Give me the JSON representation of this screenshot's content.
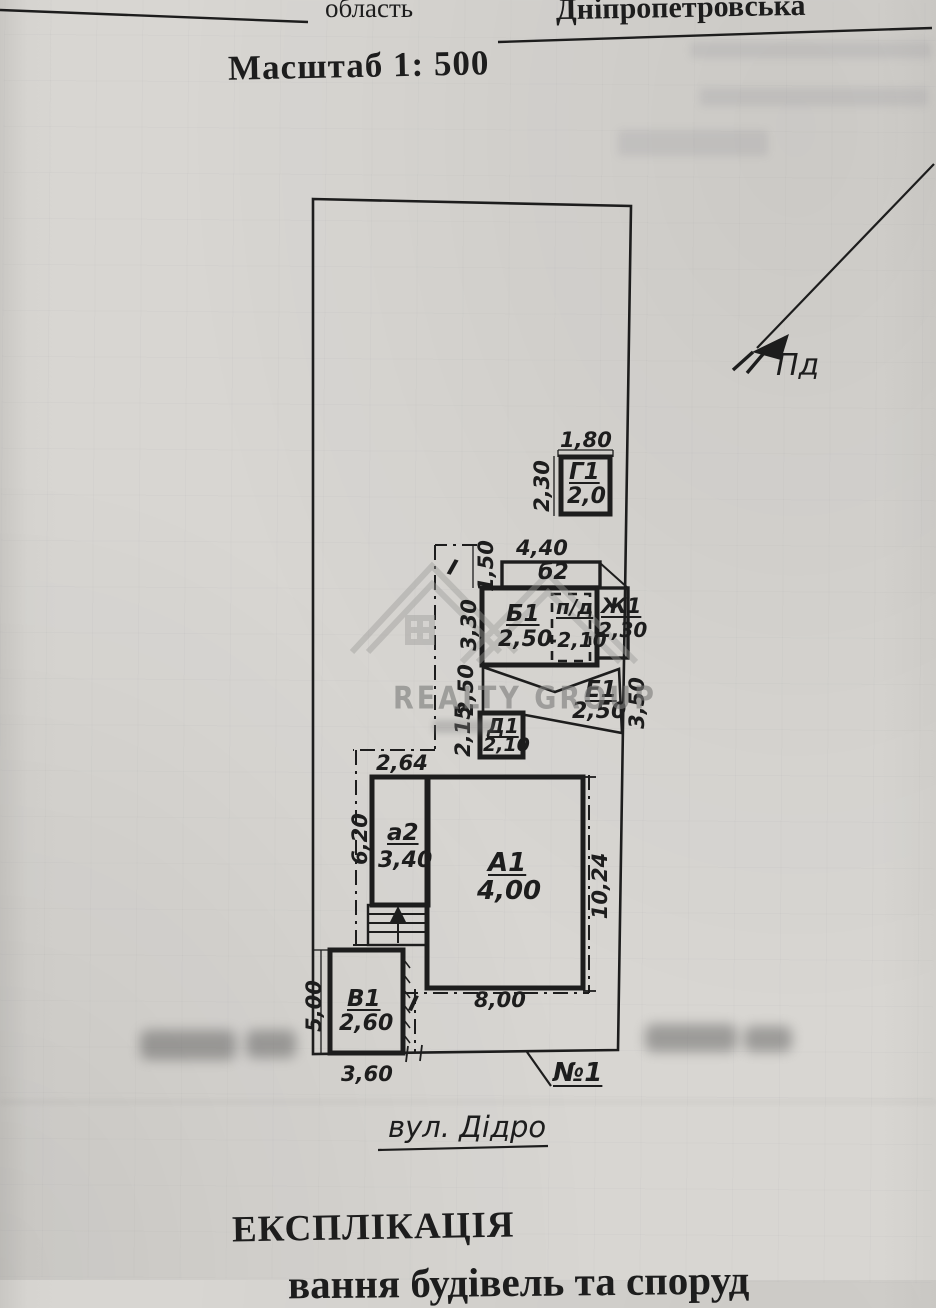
{
  "header": {
    "oblast_label": "область",
    "oblast_value": "Дніпропетровська",
    "scale_text": "Масштаб 1: 500"
  },
  "compass": {
    "south_label": "Пд"
  },
  "watermark": {
    "brand": "REALTY GROUP"
  },
  "plan": {
    "street_label": "вул. Дідро",
    "house_number": "№1",
    "boundary_mark_upper": "І",
    "boundary_mark_lower": "І",
    "buildings": {
      "g1": {
        "name": "Г1",
        "height": "2,0",
        "dim_top": "1,80",
        "dim_left": "2,30"
      },
      "b2": {
        "name": "б2",
        "dim_top": "4,40",
        "dim_left": "1,50"
      },
      "b1": {
        "name": "Б1",
        "height": "2,50",
        "dim_left": "3,30"
      },
      "pd": {
        "name": "п/д",
        "height": "-2,10"
      },
      "zh1": {
        "name": "Ж1",
        "height": "2,30"
      },
      "e1": {
        "name": "Е1",
        "height": "2,50",
        "dim_left": "2,50",
        "dim_right": "3,50"
      },
      "d1": {
        "name": "Д1",
        "height": "2,10",
        "dim_left": "2,15"
      },
      "a2": {
        "name": "а2",
        "height": "3,40",
        "dim_top": "2,64",
        "dim_left": "6,20"
      },
      "a1": {
        "name": "А1",
        "height": "4,00",
        "dim_right": "10,24",
        "dim_bottom": "8,00"
      },
      "v1": {
        "name": "В1",
        "height": "2,60",
        "dim_left": "5,00",
        "dim_bottom": "3,60"
      }
    }
  },
  "footer": {
    "title": "ЕКСПЛІКАЦІЯ",
    "subtitle_partial": "вання будівель та споруд"
  }
}
